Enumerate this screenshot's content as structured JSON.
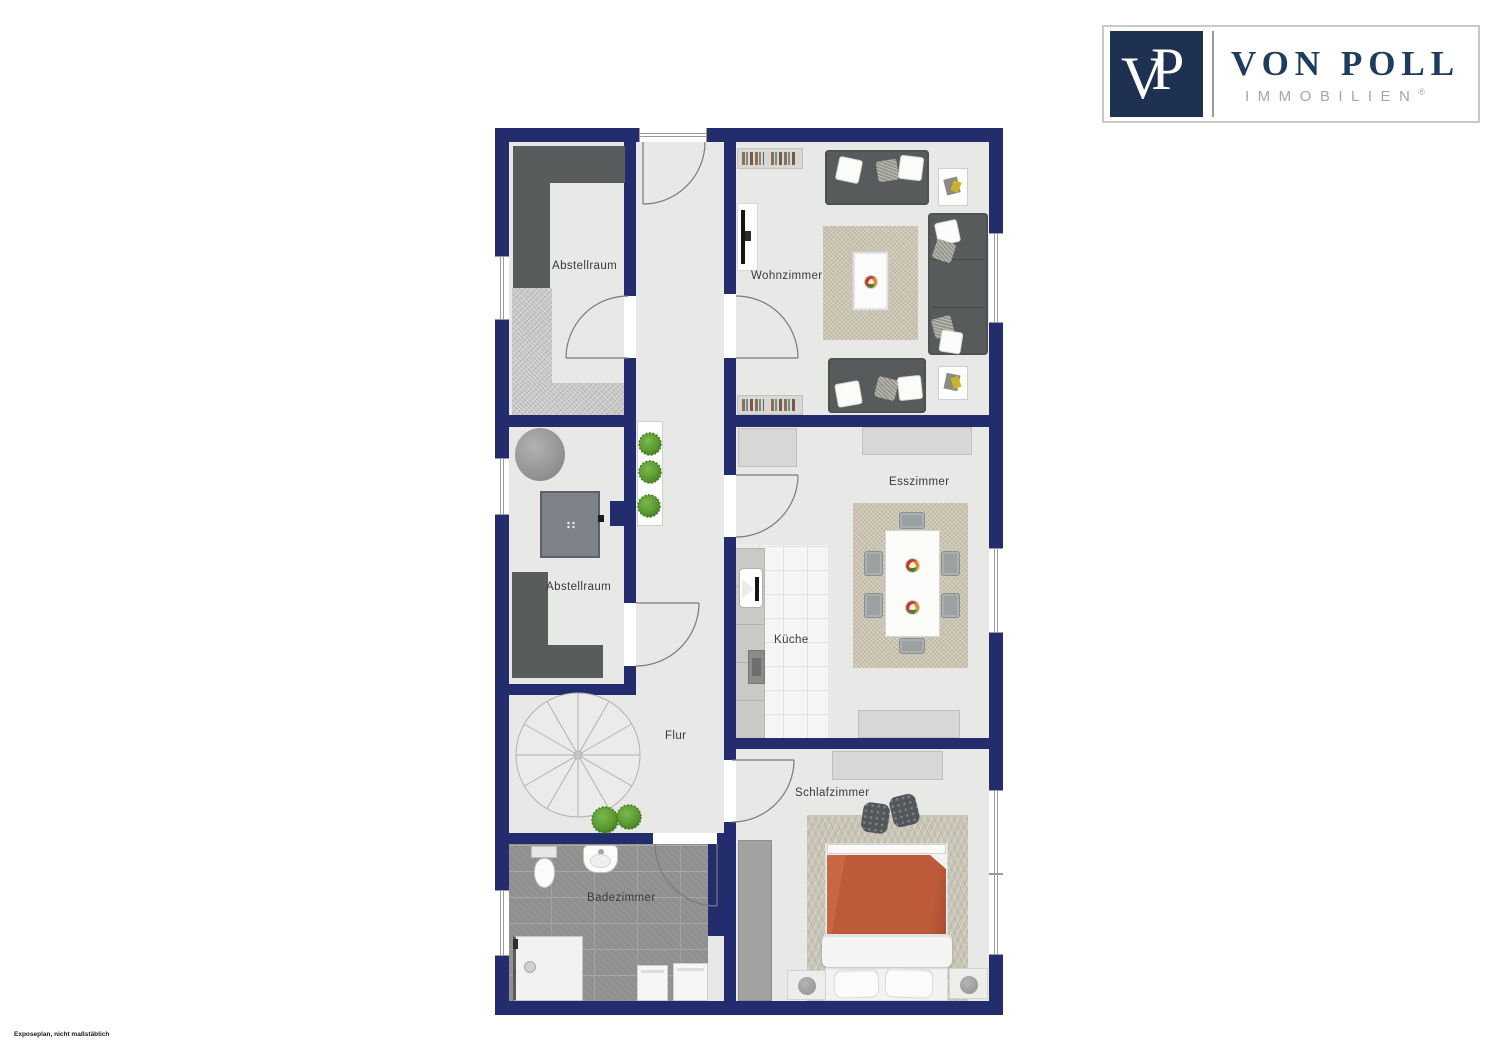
{
  "brand": {
    "monogram_v": "V",
    "monogram_p": "P",
    "name": "VON POLL",
    "subtitle": "IMMOBILIEN",
    "registered_mark": "®",
    "colors": {
      "logo_navy": "#1e3150",
      "name_navy": "#1d3c5e",
      "subtitle_gray": "#a2a7ab"
    }
  },
  "floorplan": {
    "colors": {
      "wall": "#232d6e",
      "floor": "#e8e8e7",
      "bath_tile": "#8f8f8f",
      "rug_beige": "#cbc4b1",
      "bed_duvet": "#bc5a39",
      "plant_green": "#5a9b31",
      "dark_furniture": "#595c5d"
    },
    "rooms": {
      "abstellraum1": {
        "label": "Abstellraum"
      },
      "abstellraum2": {
        "label": "Abstellraum"
      },
      "wohnzimmer": {
        "label": "Wohnzimmer"
      },
      "esszimmer": {
        "label": "Esszimmer"
      },
      "kueche": {
        "label": "Küche"
      },
      "flur": {
        "label": "Flur"
      },
      "schlafzimmer": {
        "label": "Schlafzimmer"
      },
      "badezimmer": {
        "label": "Badezimmer"
      }
    }
  },
  "footnote": "Exposeplan, nicht maßstäblich"
}
